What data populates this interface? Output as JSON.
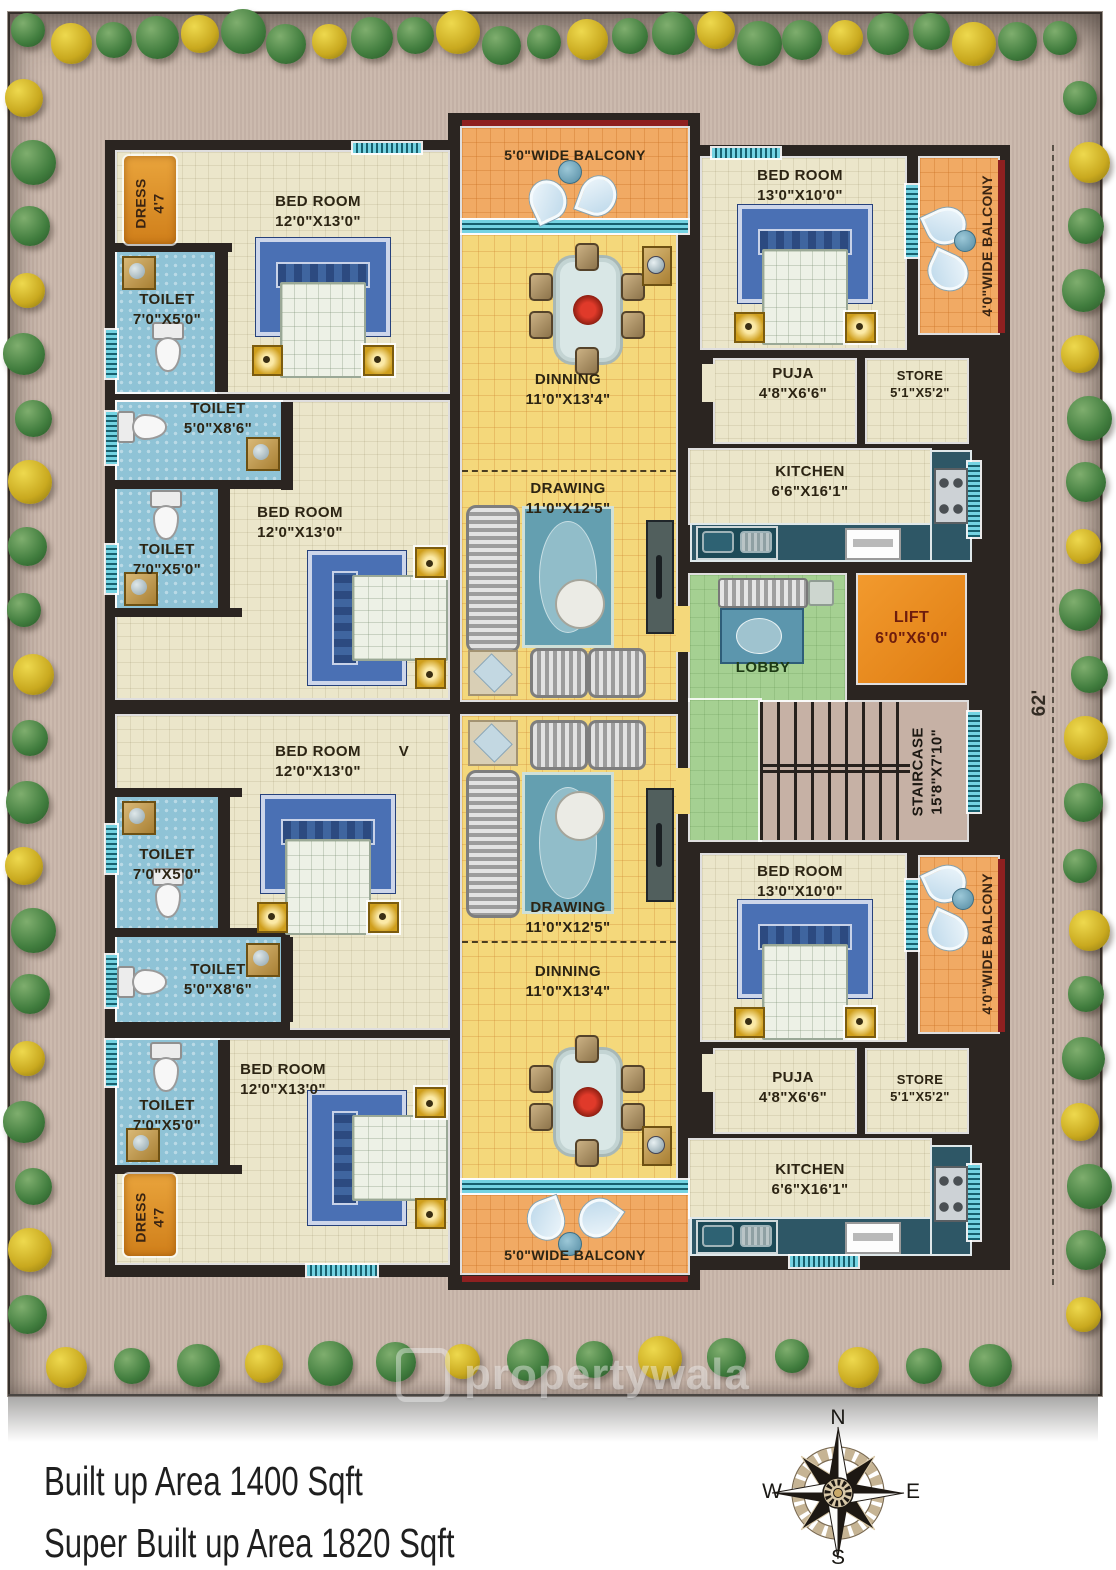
{
  "palette": {
    "wall": "#2b2521",
    "room_cream": "#ebe6ca",
    "hall_yellow": "#f4d87b",
    "toilet_blue": "#8fc3d6",
    "balcony_orange": "#f1aa64",
    "accent_orange": "#e8891f",
    "lobby_green": "#a5d092",
    "counter_teal": "#2e5766",
    "window_teal": "#74d3e2",
    "balcony_edge_red": "#8e2020",
    "site_tan": "#c9b6aa"
  },
  "rooms": {
    "dress_1": {
      "label": "DRESS",
      "dims": "4'7"
    },
    "toilet_1": {
      "label": "TOILET",
      "dims": "7'0\"X5'0\""
    },
    "bedroom_1": {
      "label": "BED ROOM",
      "dims": "12'0\"X13'0\""
    },
    "toilet_2": {
      "label": "TOILET",
      "dims": "5'0\"X8'6\""
    },
    "toilet_3": {
      "label": "TOILET",
      "dims": "7'0\"X5'0\""
    },
    "bedroom_2": {
      "label": "BED ROOM",
      "dims": "12'0\"X13'0\""
    },
    "bedroom_3": {
      "label": "BED ROOM",
      "dims": "12'0\"X13'0\"",
      "mark": "V"
    },
    "toilet_4": {
      "label": "TOILET",
      "dims": "7'0\"X5'0\""
    },
    "toilet_5": {
      "label": "TOILET",
      "dims": "5'0\"X8'6\""
    },
    "toilet_6": {
      "label": "TOILET",
      "dims": "7'0\"X5'0\""
    },
    "dress_2": {
      "label": "DRESS",
      "dims": "4'7"
    },
    "bedroom_4": {
      "label": "BED ROOM",
      "dims": "12'0\"X13'0\""
    },
    "balcony_1": {
      "label": "5'0\"WIDE BALCONY"
    },
    "dinning_1": {
      "label": "DINNING",
      "dims": "11'0\"X13'4\""
    },
    "drawing_1": {
      "label": "DRAWING",
      "dims": "11'0\"X12'5\""
    },
    "drawing_2": {
      "label": "DRAWING",
      "dims": "11'0\"X12'5\""
    },
    "dinning_2": {
      "label": "DINNING",
      "dims": "11'0\"X13'4\""
    },
    "balcony_2": {
      "label": "5'0\"WIDE BALCONY"
    },
    "bedroom_5": {
      "label": "BED ROOM",
      "dims": "13'0\"X10'0\""
    },
    "balcony_r1": {
      "label": "4'0\"WIDE BALCONY"
    },
    "puja_1": {
      "label": "PUJA",
      "dims": "4'8\"X6'6\""
    },
    "store_1": {
      "label": "STORE",
      "dims": "5'1\"X5'2\""
    },
    "kitchen_1": {
      "label": "KITCHEN",
      "dims": "6'6\"X16'1\""
    },
    "lobby": {
      "label": "LOBBY"
    },
    "lift": {
      "label": "LIFT",
      "dims": "6'0\"X6'0\""
    },
    "staircase": {
      "label": "STAIRCASE",
      "dims": "15'8\"X7'10\""
    },
    "bedroom_6": {
      "label": "BED ROOM",
      "dims": "13'0\"X10'0\""
    },
    "balcony_r2": {
      "label": "4'0\"WIDE BALCONY"
    },
    "puja_2": {
      "label": "PUJA",
      "dims": "4'8\"X6'6\""
    },
    "store_2": {
      "label": "STORE",
      "dims": "5'1\"X5'2\""
    },
    "kitchen_2": {
      "label": "KITCHEN",
      "dims": "6'6\"X16'1\""
    }
  },
  "site": {
    "depth_marker": "62'"
  },
  "watermark": {
    "text": "propertywala"
  },
  "footer": {
    "line1": "Built up Area 1400 Sqft",
    "line2": "Super Built up Area 1820 Sqft"
  },
  "compass": {
    "north": "N",
    "south": "S",
    "east": "E",
    "west": "W"
  }
}
